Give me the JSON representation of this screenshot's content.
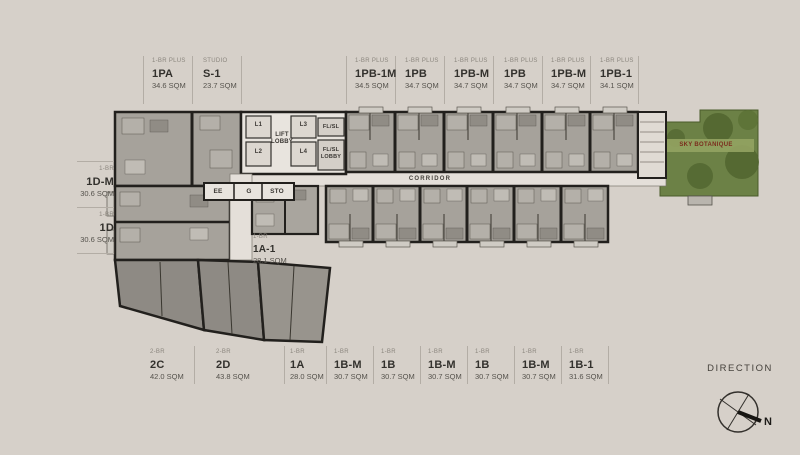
{
  "top_units": [
    {
      "type": "1-BR PLUS",
      "name": "1PA",
      "area": "34.6 SQM"
    },
    {
      "type": "STUDIO",
      "name": "S-1",
      "area": "23.7 SQM"
    },
    {
      "type": "1-BR PLUS",
      "name": "1PB-1M",
      "area": "34.5 SQM"
    },
    {
      "type": "1-BR PLUS",
      "name": "1PB",
      "area": "34.7 SQM"
    },
    {
      "type": "1-BR PLUS",
      "name": "1PB-M",
      "area": "34.7 SQM"
    },
    {
      "type": "1-BR PLUS",
      "name": "1PB",
      "area": "34.7 SQM"
    },
    {
      "type": "1-BR PLUS",
      "name": "1PB-M",
      "area": "34.7 SQM"
    },
    {
      "type": "1-BR PLUS",
      "name": "1PB-1",
      "area": "34.1 SQM"
    }
  ],
  "left_units": [
    {
      "type": "1-BR",
      "name": "1D-M",
      "area": "30.6 SQM"
    },
    {
      "type": "1-BR",
      "name": "1D",
      "area": "30.6 SQM"
    }
  ],
  "bottom_units": [
    {
      "type": "2-BR",
      "name": "2C",
      "area": "42.0 SQM"
    },
    {
      "type": "2-BR",
      "name": "2D",
      "area": "43.8 SQM"
    },
    {
      "type": "1-BR",
      "name": "1A",
      "area": "28.0 SQM"
    },
    {
      "type": "1-BR",
      "name": "1B-M",
      "area": "30.7 SQM"
    },
    {
      "type": "1-BR",
      "name": "1B",
      "area": "30.7 SQM"
    },
    {
      "type": "1-BR",
      "name": "1B-M",
      "area": "30.7 SQM"
    },
    {
      "type": "1-BR",
      "name": "1B",
      "area": "30.7 SQM"
    },
    {
      "type": "1-BR",
      "name": "1B-M",
      "area": "30.7 SQM"
    },
    {
      "type": "1-BR",
      "name": "1B-1",
      "area": "31.6 SQM"
    }
  ],
  "plan_unit": {
    "type": "1-BR",
    "name": "1A-1",
    "area": "28.1 SQM"
  },
  "rooms": {
    "l1": "L1",
    "l2": "L2",
    "l3": "L3",
    "l4": "L4",
    "lift_lobby": "LIFT LOBBY",
    "fl_sl": "FL/SL",
    "fl_sl_lobby": "FL/SL LOBBY",
    "ee": "EE",
    "g": "G",
    "sto": "STO",
    "corridor": "CORRIDOR"
  },
  "garden": {
    "label": "SKY BOTANIQUE"
  },
  "compass": {
    "title": "DIRECTION",
    "north_label": "N"
  },
  "colors": {
    "background": "#d6d0c9",
    "unit_fill": "#a6a29b",
    "unit_dark_fill": "#8e8a84",
    "wall": "#22201d",
    "corridor_fill": "#e4dfd9",
    "garden_green": "#6c8146",
    "garden_dark": "#51652f",
    "accent_red": "#7b2d1d"
  }
}
